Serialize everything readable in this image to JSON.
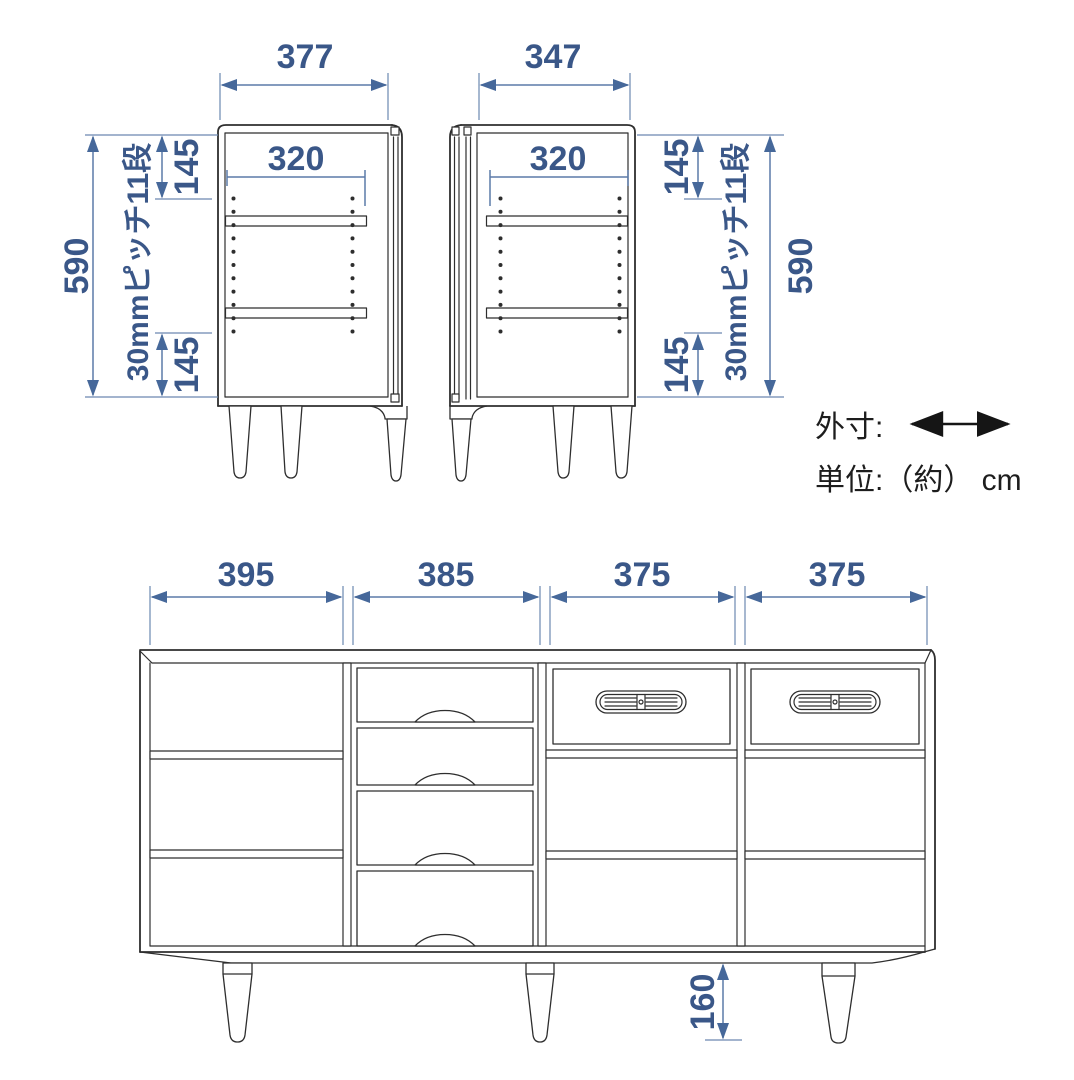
{
  "diagram": {
    "top_left_cabinet": {
      "width_label": "377",
      "shelf_depth_label": "320",
      "top_offset_label": "145",
      "bottom_offset_label": "145",
      "height_label": "590",
      "pitch_label": "30mmピッチ11段"
    },
    "top_right_cabinet": {
      "width_label": "347",
      "shelf_depth_label": "320",
      "top_offset_label": "145",
      "bottom_offset_label": "145",
      "height_label": "590",
      "pitch_label": "30mmピッチ11段"
    },
    "legend": {
      "outer_dim_label": "外寸:",
      "unit_label": "単位:（約） cm"
    },
    "sideboard": {
      "section_width_labels": [
        "395",
        "385",
        "375",
        "375"
      ],
      "leg_height_label": "160"
    },
    "colors": {
      "dimension_text": "#3a5788",
      "dimension_line": "#5b7aa8",
      "outline": "#2e2e2e",
      "background": "#ffffff"
    }
  }
}
